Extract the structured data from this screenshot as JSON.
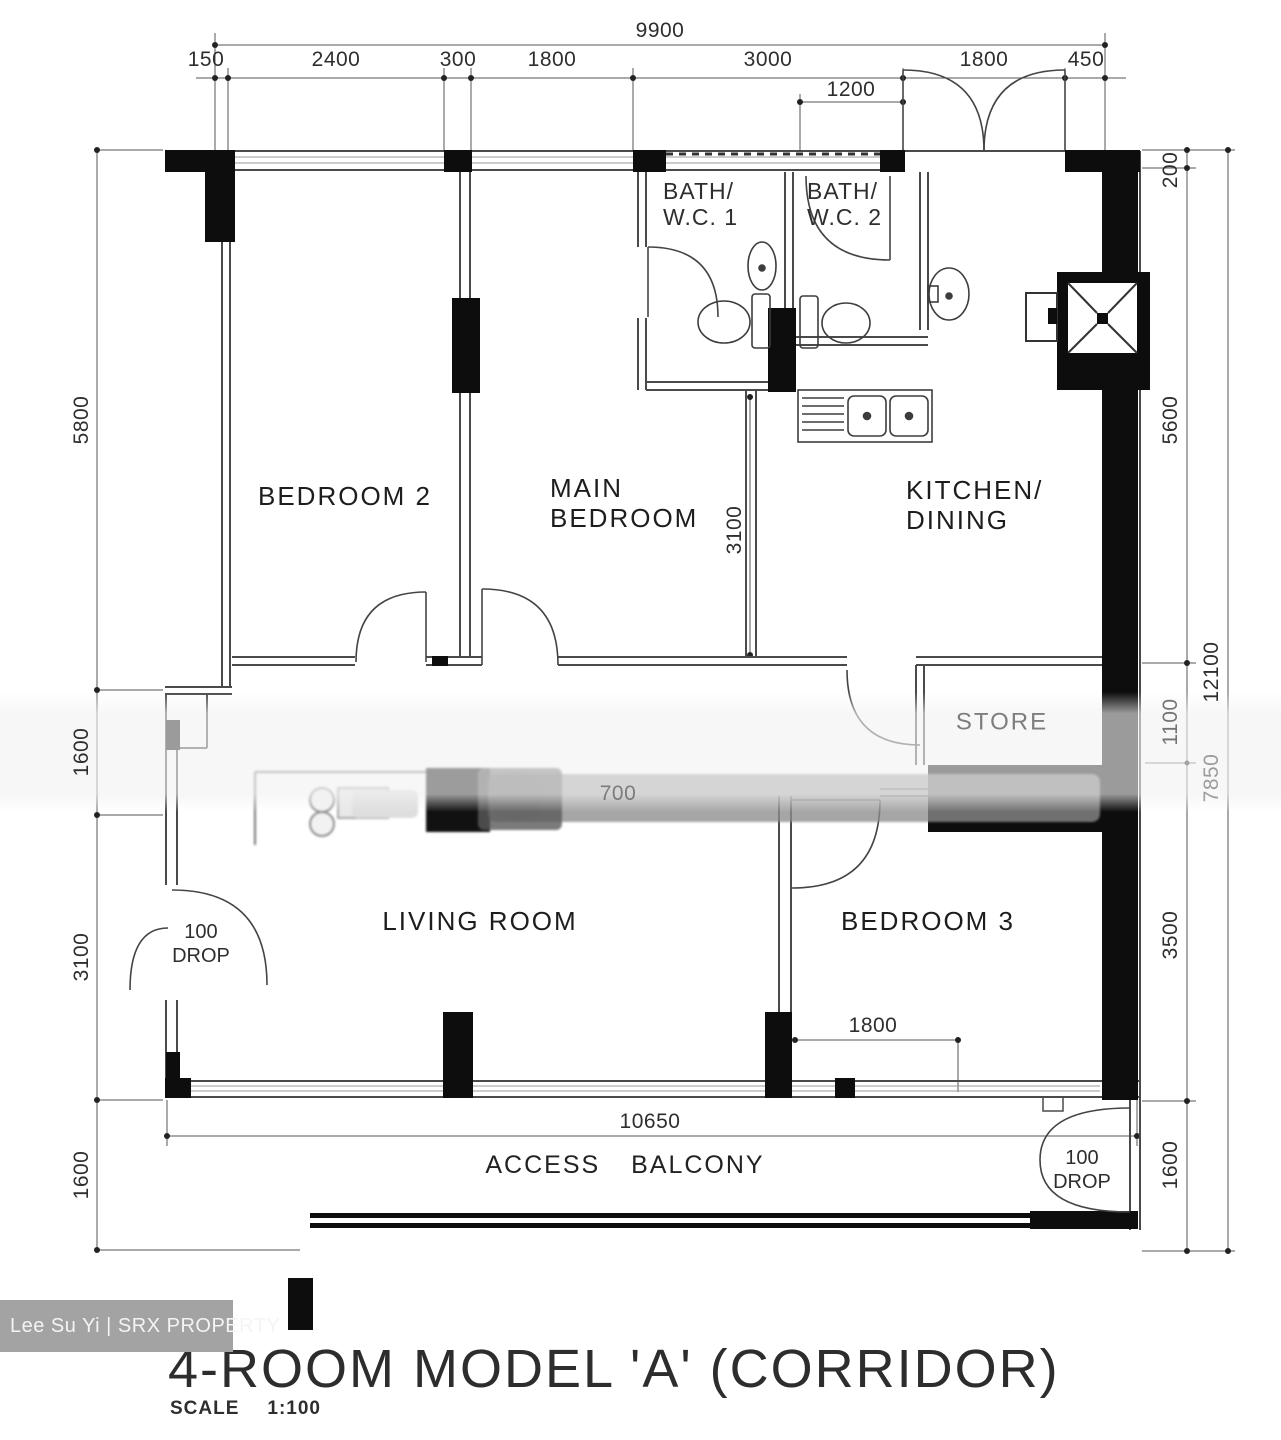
{
  "title": "4-ROOM MODEL 'A' (CORRIDOR)",
  "scale_label": "SCALE",
  "scale_value": "1:100",
  "watermark": "Lee Su Yi | SRX PROPERTY",
  "rooms": {
    "bedroom2": "BEDROOM 2",
    "main_bedroom": "MAIN\nBEDROOM",
    "kitchen": "KITCHEN/\nDINING",
    "living": "LIVING ROOM",
    "bedroom3": "BEDROOM 3",
    "bath1": "BATH/\nW.C. 1",
    "bath2": "BATH/\nW.C. 2",
    "store": "STORE",
    "access_balcony": "ACCESS BALCONY"
  },
  "annotations": {
    "drop_left": "100\nDROP",
    "drop_right": "100\nDROP"
  },
  "dims": {
    "top_total": "9900",
    "top_segments": [
      "150",
      "2400",
      "300",
      "1800",
      "3000",
      "1800",
      "450"
    ],
    "sub_1200": "1200",
    "left_dims": [
      "5800",
      "1600",
      "3100",
      "1600"
    ],
    "right_dims": [
      "200",
      "5600",
      "1100",
      "3500",
      "1600"
    ],
    "right_total": "12100",
    "right_faint": "7850",
    "bottom_total": "10650",
    "bedroom3_door": "1800",
    "main_bedroom_depth": "3100",
    "corridor_faint": "700"
  }
}
